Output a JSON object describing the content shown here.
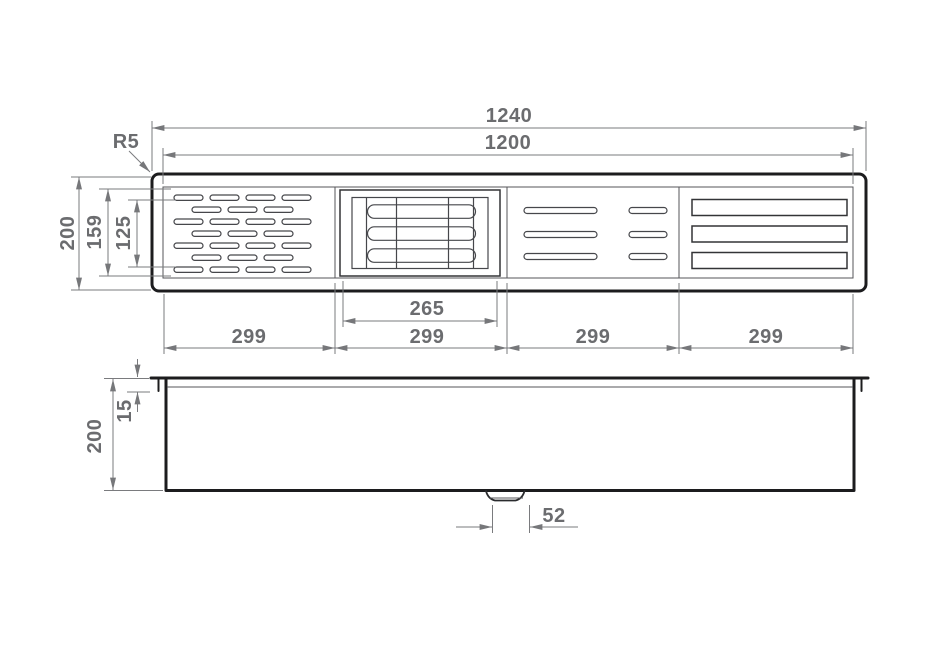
{
  "drawing_type": "technical-dimension-drawing",
  "colors": {
    "outline": "#1c1c1e",
    "feature_lines": "#46474b",
    "dimension_lines": "#7a7b7e",
    "dimension_text": "#6b6c6f",
    "background": "#ffffff"
  },
  "top_view": {
    "width_total": "1240",
    "width_inner": "1200",
    "height_total": "200",
    "height_inner": "159",
    "height_slots": "125",
    "corner_radius_label": "R5",
    "grate_width": "265",
    "bay_widths": [
      "299",
      "299",
      "299",
      "299"
    ]
  },
  "side_view": {
    "height_total": "200",
    "rim_depth": "15",
    "outlet_width": "52"
  }
}
